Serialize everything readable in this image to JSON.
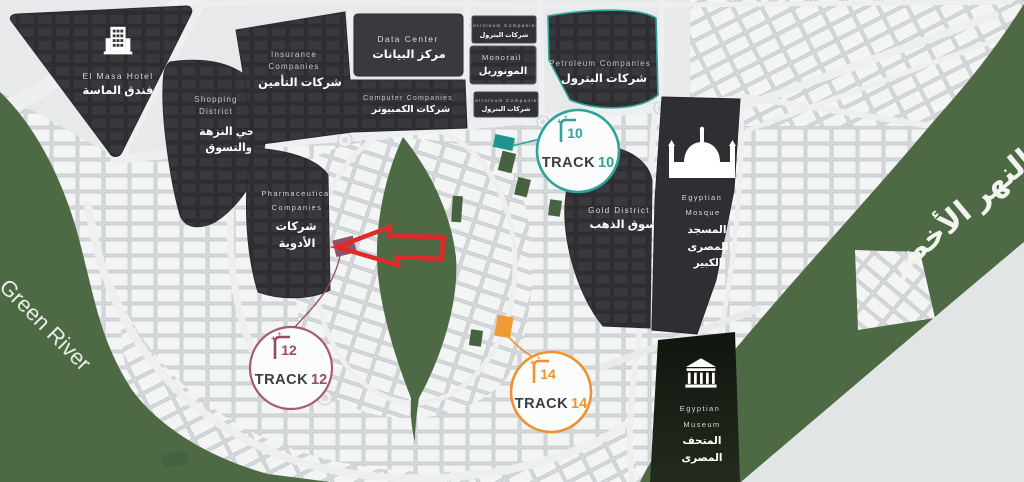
{
  "colors": {
    "map_background": "#e7e9ea",
    "green": "#4d6a45",
    "dark_district": "#323237",
    "track10_accent": "#2fa29a",
    "track12_accent": "#9b4a62",
    "track14_accent": "#f0922f",
    "highlight_red": "#e02a2a",
    "highlight_plot_purple": "#8a5570"
  },
  "green_river": {
    "label_en": "Green River",
    "label_ar": "النهر الأخضر"
  },
  "districts": {
    "hotel": {
      "name_en": "El Masa Hotel",
      "name_ar": "فندق الماسة"
    },
    "shopping": {
      "name_en_1": "Shopping",
      "name_en_2": "District",
      "name_ar_1": "حي النزهة",
      "name_ar_2": "والتسوق"
    },
    "insurance": {
      "name_en_1": "Insurance",
      "name_en_2": "Companies",
      "name_ar": "شركات التأمين"
    },
    "data_center": {
      "name_en": "Data Center",
      "name_ar": "مركز البيانات"
    },
    "computer": {
      "name_en": "Computer Companies",
      "name_ar": "شركات الكمبيوتر"
    },
    "petroleum_north": {
      "name_en": "Petroleum Companies",
      "name_ar": "شركات البترول"
    },
    "monorail": {
      "name_en": "Monorail",
      "name_ar": "المونوريل"
    },
    "petroleum_south": {
      "name_en": "Petroleum Companies",
      "name_ar": "شركات البترول"
    },
    "petroleum_main": {
      "name_en": "Petroleum Companies",
      "name_ar": "شركات البترول"
    },
    "pharmaceutical": {
      "name_en_1": "Pharmaceutical",
      "name_en_2": "Companies",
      "name_ar_1": "شركات",
      "name_ar_2": "الأدوية"
    },
    "gold": {
      "name_en": "Gold District",
      "name_ar": "سوق الذهب"
    },
    "mosque": {
      "name_en_1": "Egyptian",
      "name_en_2": "Mosque",
      "name_ar_1": "المسجد",
      "name_ar_2": "المصرى",
      "name_ar_3": "الكبير"
    },
    "museum": {
      "name_en_1": "Egyptian",
      "name_en_2": "Museum",
      "name_ar_1": "المتحف",
      "name_ar_2": "المصرى"
    }
  },
  "markers": {
    "track10": {
      "word": "TRACK",
      "number": "10"
    },
    "track12": {
      "word": "TRACK",
      "number": "12"
    },
    "track14": {
      "word": "TRACK",
      "number": "14"
    }
  }
}
